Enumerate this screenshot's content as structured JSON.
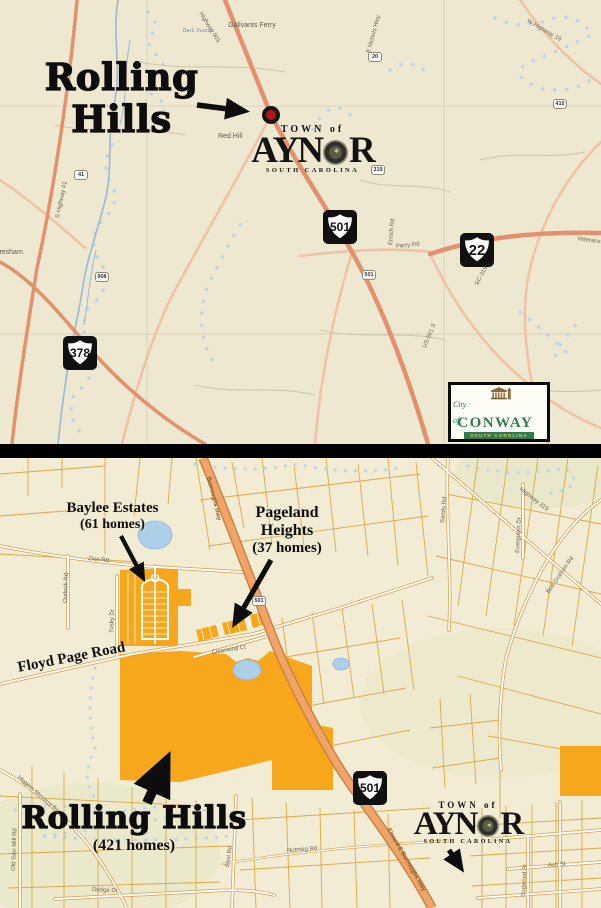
{
  "top": {
    "callout": {
      "line1": "Rolling",
      "line2": "Hills"
    },
    "places": {
      "galivants_ferry": "Galivants Ferry",
      "back_swamp": "Back Swamp",
      "red_hill": "Red Hill",
      "gresham": "Gresham"
    },
    "roads": {
      "hwy501_n": "Highway 501",
      "hwy41": "S Highway 41",
      "nichols": "E Nichols Hwy",
      "w_hwy19": "W Highway 19",
      "perry": "Perry Rd",
      "enoch": "Enoch Rd",
      "sc319": "SC-319 E",
      "us501_s": "US-501 S",
      "veterans": "Veterans Hwy"
    },
    "shields": {
      "us501": "501",
      "sc22": "22",
      "us378": "378"
    },
    "mini_shields": {
      "m41": "41",
      "m319": "319",
      "m908": "908",
      "m410": "410",
      "m20": "20",
      "m501": "501"
    },
    "aynor_logo": {
      "town_of": "TOWN of",
      "name_left": "AYN",
      "name_right": "R",
      "state": "SOUTH CAROLINA"
    },
    "conway_logo": {
      "city_of": "City of",
      "name": "CONWAY",
      "state": "SOUTH CAROLINA"
    }
  },
  "bottom": {
    "callouts": {
      "baylee": {
        "line1": "Baylee Estates",
        "line2": "(61 homes)"
      },
      "pageland": {
        "line1": "Pageland",
        "line2": "Heights",
        "line3": "(37 homes)"
      },
      "rolling": {
        "line1": "Rolling Hills",
        "line2": "(421 homes)"
      }
    },
    "roads": {
      "floyd_page": "Floyd Page Road",
      "zion": "Zion Rd",
      "outlook": "Outlook Rd",
      "tusky": "Tusky Dr",
      "clearwind": "Clearwind Ct",
      "nutmeg": "Nutmeg Rd",
      "dodge": "Dodge Dr",
      "higgins": "Higgins Shortcut Rd",
      "old_saw_mill": "Old Saw Mill Rd",
      "burroughs": "Burroughs Hwy",
      "elward": "Elward E Burroughs Hwy",
      "bud_graham": "Bud Graham Rd",
      "evergreen": "Evergreen Dr",
      "hwy319": "Highway 319",
      "sandy": "Sandy Rd",
      "best": "Best Rd",
      "ash": "Ash St",
      "dogwood": "Dogwood St"
    },
    "shields": {
      "us501": "501",
      "m501": "501"
    },
    "aynor_logo": {
      "town_of": "TOWN of",
      "name_left": "AYN",
      "name_right": "R",
      "state": "SOUTH CAROLINA"
    }
  },
  "colors": {
    "highlight": "#F7A71B",
    "parcel_line": "#DFA43A",
    "major_road": "#E2916C",
    "water": "#AECFE8",
    "map_bg_top": "#EFE8D0",
    "map_bg_bottom": "#F1ECD3",
    "conway_green": "#2E7D4F",
    "marker_red": "#B01818"
  }
}
